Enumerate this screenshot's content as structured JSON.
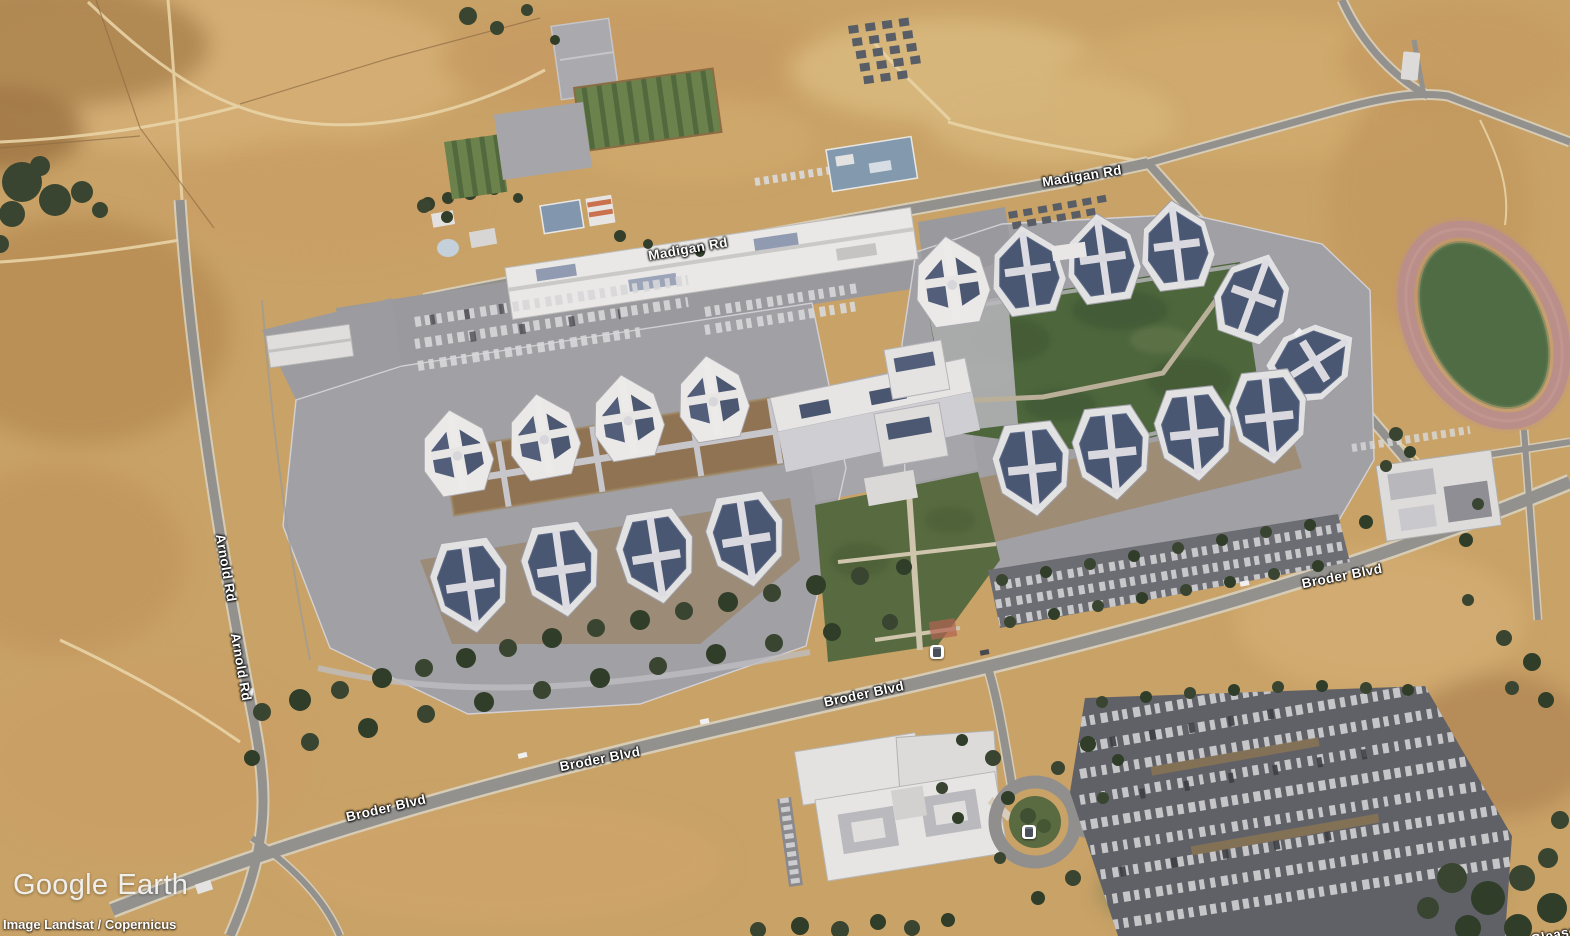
{
  "app": {
    "name": "Google Earth"
  },
  "branding": {
    "logo_word1": "Google",
    "logo_word2": "Earth"
  },
  "attribution": {
    "imagery_credit": "Image Landsat / Copernicus"
  },
  "map": {
    "view": "3D aerial satellite imagery",
    "road_labels": [
      {
        "text": "Arnold Rd"
      },
      {
        "text": "Arnold Rd"
      },
      {
        "text": "Broder Blvd"
      },
      {
        "text": "Broder Blvd"
      },
      {
        "text": "Broder Blvd"
      },
      {
        "text": "Broder Blvd"
      },
      {
        "text": "Madigan Rd"
      },
      {
        "text": "Madigan Rd"
      },
      {
        "text": "Gleason Dr"
      }
    ],
    "poi_icons": [
      {
        "name": "transit-stop"
      },
      {
        "name": "transit-stop"
      }
    ],
    "palette": {
      "dry_grass": "#c8a164",
      "dirt_path": "#e8d2a4",
      "road_asphalt": "#908f8c",
      "compound_pavement": "#a09fa4",
      "roof_white": "#e9e8e6",
      "solar_panel": "#475471",
      "tree_green": "#36422c",
      "courtyard_green": "#4a6339",
      "track_surface": "#b98d87",
      "track_infield": "#4c6a42",
      "parking_asphalt": "#5d5e64",
      "label_text": "#ffffff"
    }
  }
}
